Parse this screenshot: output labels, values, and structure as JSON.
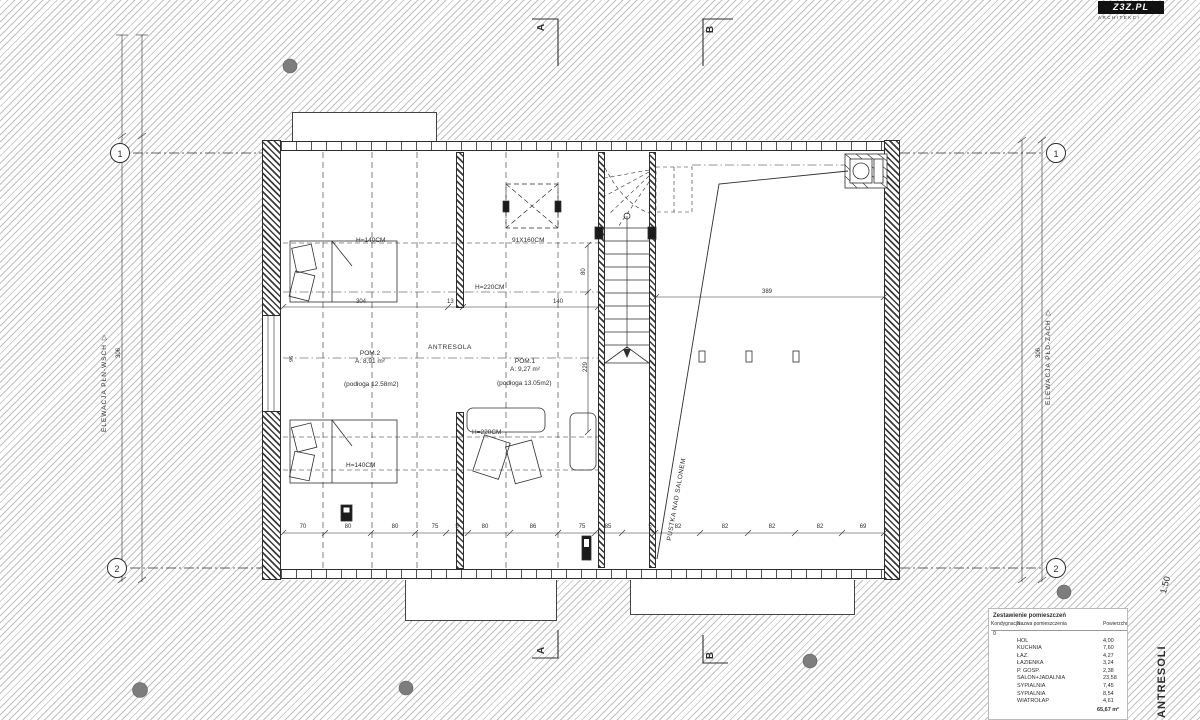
{
  "logo": {
    "name": "Z3Z.PL",
    "tagline": "ARCHITEKCI"
  },
  "titleblock": {
    "title": "ANTRESOLI",
    "scale": "1:50"
  },
  "elevations": {
    "left": "ELEWACJA PŁN-WSCH",
    "right": "ELEWACJA PŁD-ZACH"
  },
  "sections": {
    "a": "A",
    "b": "B"
  },
  "grid": {
    "r1": "1",
    "r2": "2"
  },
  "rooms": {
    "antresola": "ANTRESOLA",
    "pom2_name": "POM.2",
    "pom2_area": "A: 8,91 m²",
    "pom2_floor": "(podłoga 12.58m2)",
    "pom1_name": "POM.1",
    "pom1_area": "A: 9,27 m²",
    "pom1_floor": "(podłoga 13.05m2)",
    "void": "PUSTKA NAD SALONEM"
  },
  "labels": {
    "h140_top": "H=140CM",
    "h220_top": "H=220CM",
    "h220_mid": "H=220CM",
    "h140_bottom": "H=140CM",
    "skylight": "91X160CM",
    "knee_wall": "96"
  },
  "dims": {
    "mid": [
      "304",
      "13",
      "140"
    ],
    "span_right": "389",
    "stair_80": "80",
    "stair_229": "229",
    "outer_left": "306",
    "outer_right": "306",
    "bottom": [
      "70",
      "80",
      "80",
      "75",
      "5",
      "80",
      "86",
      "75",
      "85",
      "5",
      "82",
      "82",
      "82",
      "82",
      "69"
    ]
  },
  "table": {
    "title": "Zestawienie pomieszczeń",
    "col_storey": "Kondygnacja",
    "col_name": "Nazwa pomieszczenia",
    "col_area": "Powierzchnia",
    "storey": "0",
    "rows": [
      {
        "name": "HOL",
        "area": "4,00"
      },
      {
        "name": "KUCHNIA",
        "area": "7,60"
      },
      {
        "name": "ŁAZ.",
        "area": "4,27"
      },
      {
        "name": "ŁAZIENKA",
        "area": "3,24"
      },
      {
        "name": "P. GOSP.",
        "area": "2,38"
      },
      {
        "name": "SALON+JADALNIA",
        "area": "23,58"
      },
      {
        "name": "SYPIALNIA",
        "area": "7,45"
      },
      {
        "name": "SYPIALNIA",
        "area": "8,54"
      },
      {
        "name": "WIATROŁAP",
        "area": "4,61"
      }
    ],
    "total": "65,67 m²"
  },
  "colors": {
    "paper": "#ffffff",
    "hatch": "#828282",
    "line": "#2e2e2e",
    "dot": "#7d7d7d"
  }
}
